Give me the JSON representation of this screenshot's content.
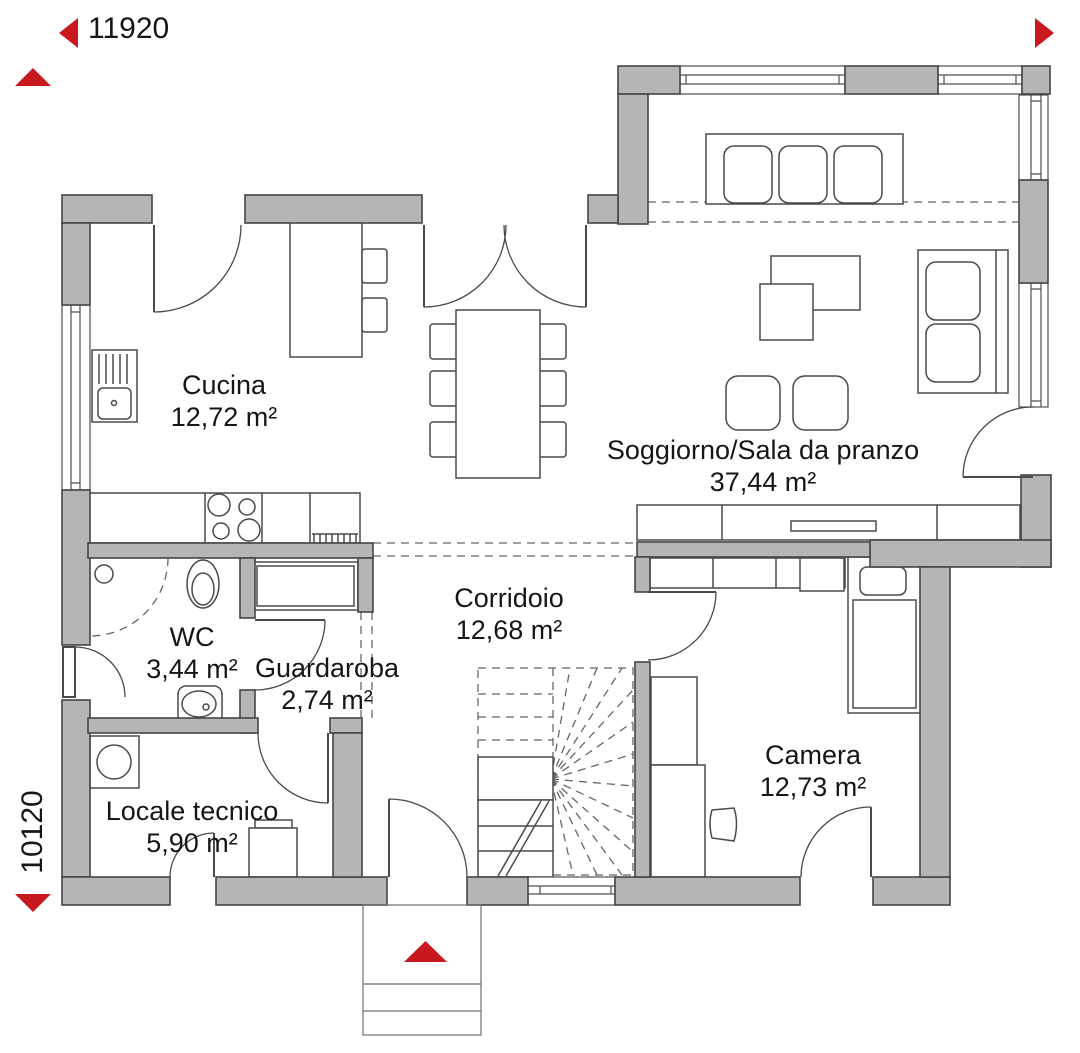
{
  "colors": {
    "wall_fill": "#b5b5b5",
    "wall_stroke": "#454545",
    "line": "#4a4a4a",
    "dash": "#666666",
    "red": "#c8191e",
    "text": "#161616"
  },
  "dimensions": {
    "horizontal": "11920",
    "vertical": "10120"
  },
  "rooms": [
    {
      "id": "cucina",
      "name": "Cucina",
      "area": "12,72 m²"
    },
    {
      "id": "soggiorno",
      "name": "Soggiorno/Sala da pranzo",
      "area": "37,44 m²"
    },
    {
      "id": "corridoio",
      "name": "Corridoio",
      "area": "12,68 m²"
    },
    {
      "id": "wc",
      "name": "WC",
      "area": "3,44 m²"
    },
    {
      "id": "guardaroba",
      "name": "Guardaroba",
      "area": "2,74 m²"
    },
    {
      "id": "locale-tecnico",
      "name": "Locale tecnico",
      "area": "5,90 m²"
    },
    {
      "id": "camera",
      "name": "Camera",
      "area": "12,73 m²"
    }
  ]
}
